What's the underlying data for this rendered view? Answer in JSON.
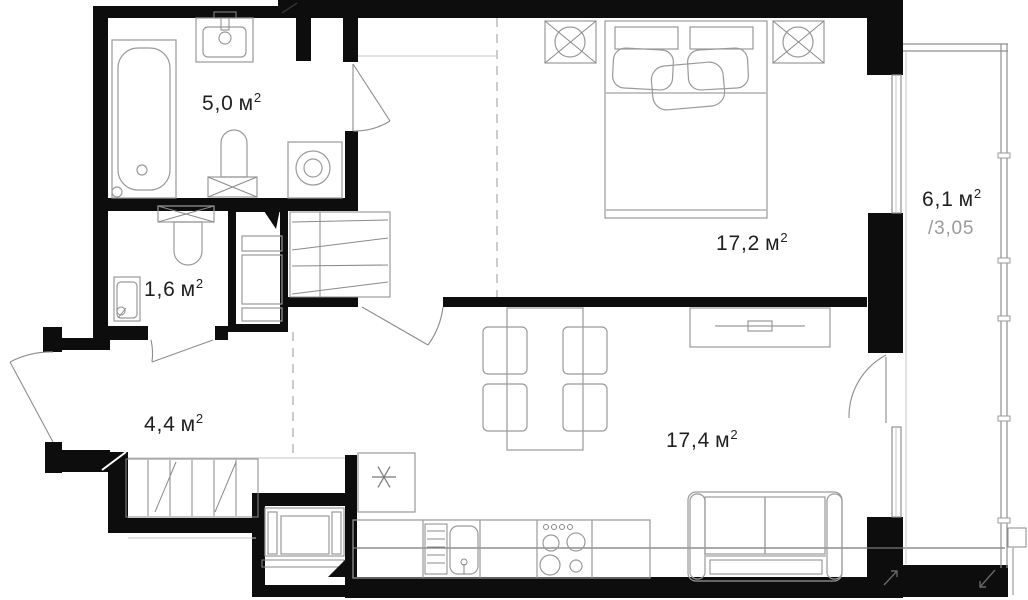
{
  "plan_title": "apartment-floor-plan",
  "rooms": {
    "bathroom": {
      "value": "5,0",
      "unit": "м",
      "sup": "2"
    },
    "wc": {
      "value": "1,6",
      "unit": "м",
      "sup": "2"
    },
    "hallway": {
      "value": "4,4",
      "unit": "м",
      "sup": "2"
    },
    "bedroom": {
      "value": "17,2",
      "unit": "м",
      "sup": "2"
    },
    "living_kitchen": {
      "value": "17,4",
      "unit": "м",
      "sup": "2"
    },
    "balcony": {
      "value": "6,1",
      "unit": "м",
      "sup": "2",
      "coefficient": "/3,05"
    }
  },
  "colors": {
    "wall": "#0d0d0d",
    "fixture_line": "#9a9a9a",
    "coefficient_text": "#9a9a9a",
    "label_text": "#1f1f1f",
    "background": "#ffffff"
  }
}
